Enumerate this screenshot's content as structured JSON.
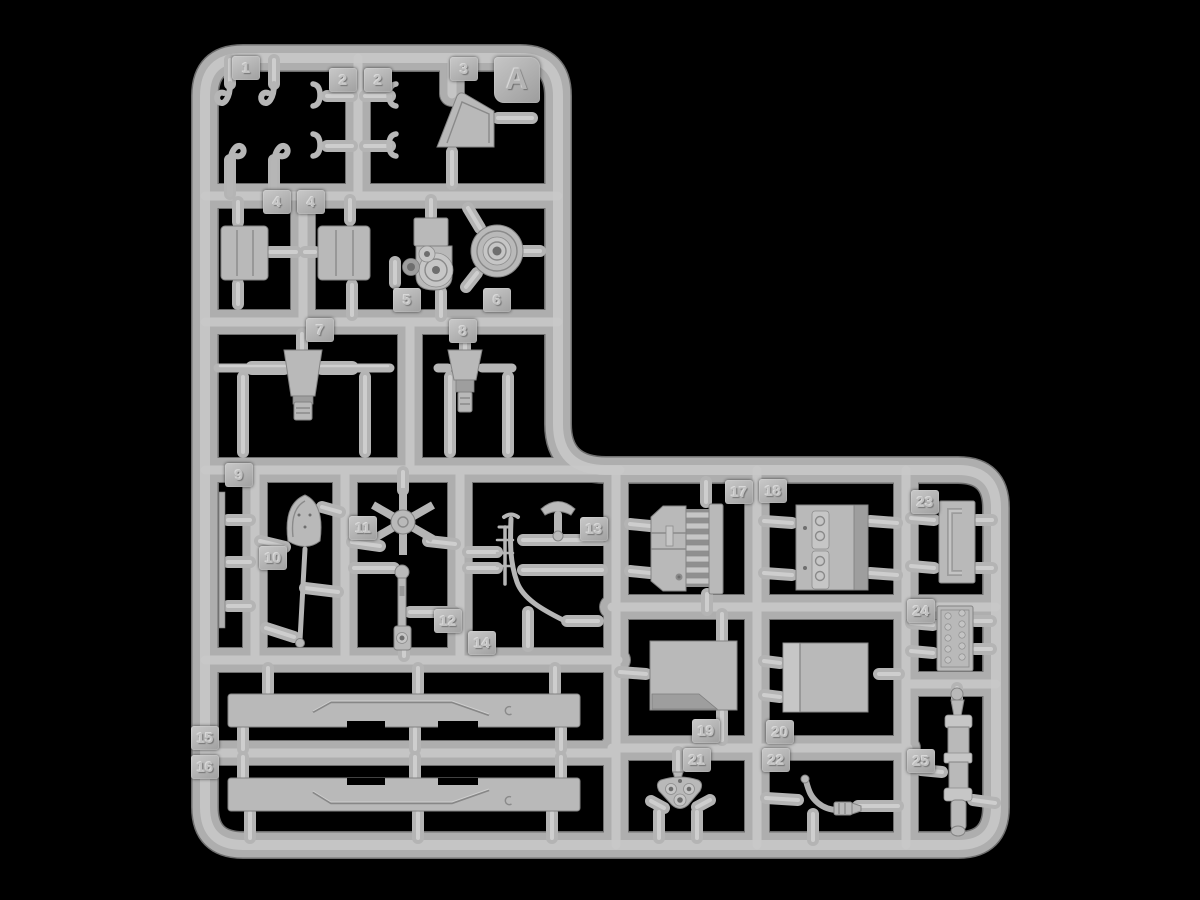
{
  "scene": {
    "background": "#000000",
    "plastic_color": "#b4b4b4",
    "plastic_highlight": "#c9c9c9",
    "plastic_shadow": "#6f6f6f"
  },
  "sprue": {
    "letter": "A",
    "tags": [
      {
        "label": "1"
      },
      {
        "label": "2"
      },
      {
        "label": "2"
      },
      {
        "label": "3"
      },
      {
        "label": "4"
      },
      {
        "label": "4"
      },
      {
        "label": "5"
      },
      {
        "label": "6"
      },
      {
        "label": "7"
      },
      {
        "label": "8"
      },
      {
        "label": "9"
      },
      {
        "label": "10"
      },
      {
        "label": "11"
      },
      {
        "label": "12"
      },
      {
        "label": "13"
      },
      {
        "label": "14"
      },
      {
        "label": "15"
      },
      {
        "label": "16"
      },
      {
        "label": "17"
      },
      {
        "label": "18"
      },
      {
        "label": "19"
      },
      {
        "label": "20"
      },
      {
        "label": "21"
      },
      {
        "label": "22"
      },
      {
        "label": "23"
      },
      {
        "label": "24"
      },
      {
        "label": "25"
      }
    ]
  }
}
